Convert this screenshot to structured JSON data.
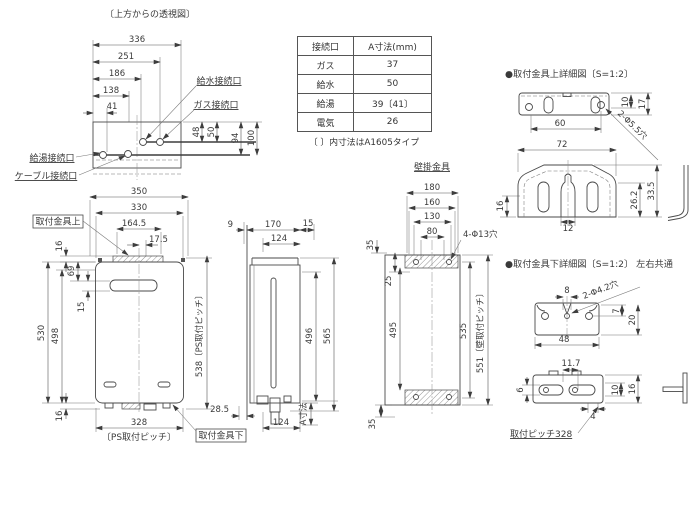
{
  "top_view": {
    "title": "〔上方からの透視図〕",
    "dim_336": "336",
    "dim_251": "251",
    "dim_186": "186",
    "dim_138": "138",
    "dim_41": "41",
    "dim_48": "48",
    "dim_50": "50",
    "dim_94": "94",
    "dim_100": "100",
    "label_water": "給水接続口",
    "label_gas": "ガス接続口",
    "label_hotwater": "給湯接続口",
    "label_cable": "ケーブル接続口"
  },
  "table": {
    "headers": [
      "接続口",
      "A寸法(mm)"
    ],
    "rows": [
      [
        "ガス",
        "37"
      ],
      [
        "給水",
        "50"
      ],
      [
        "給湯",
        "39〔41〕"
      ],
      [
        "電気",
        "26"
      ]
    ],
    "note": "〔 〕内寸法はA1605タイプ"
  },
  "front_view": {
    "dim_350": "350",
    "dim_330": "330",
    "dim_164_5": "164.5",
    "dim_17_5": "17.5",
    "dim_16_top": "16",
    "dim_69": "69",
    "dim_15": "15",
    "dim_530": "530",
    "dim_498": "498",
    "dim_16_bottom": "16",
    "dim_538": "538〔PS取付ピッチ〕",
    "dim_328": "328",
    "dim_328_note": "〔PS取付ピッチ〕",
    "label_bracket_top": "取付金具上",
    "label_bracket_bottom": "取付金具下",
    "dim_28_5": "28.5"
  },
  "side_view": {
    "dim_9": "9",
    "dim_170": "170",
    "dim_15": "15",
    "dim_124_top": "124",
    "dim_496": "496",
    "dim_565": "565",
    "dim_124_bottom": "124",
    "dim_a": "A寸法"
  },
  "rear_view": {
    "title": "壁掛金具",
    "dim_180": "180",
    "dim_160": "160",
    "dim_130": "130",
    "dim_80": "80",
    "label_holes": "4-Φ13穴",
    "dim_35_top": "35",
    "dim_25": "25",
    "dim_495": "495",
    "dim_535": "535",
    "dim_551": "551〔壁取付ピッチ〕",
    "dim_35_bottom": "35"
  },
  "bracket_upper": {
    "title": "●取付金具上詳細図〔S=1:2〕",
    "dim_60": "60",
    "dim_10": "10",
    "dim_17": "17",
    "label_holes": "2-Φ5.5穴",
    "dim_72": "72",
    "dim_16": "16",
    "dim_12": "12",
    "dim_26_2": "26.2",
    "dim_33_5": "33.5"
  },
  "bracket_lower": {
    "title": "●取付金具下詳細図〔S=1:2〕 左右共通",
    "dim_8": "8",
    "label_holes": "2-Φ4.2穴",
    "dim_7": "7",
    "dim_20": "20",
    "dim_48": "48",
    "dim_11_7": "11.7",
    "dim_6": "6",
    "dim_10": "10",
    "dim_16": "16",
    "dim_4": "4",
    "label_pitch": "取付ピッチ328"
  }
}
